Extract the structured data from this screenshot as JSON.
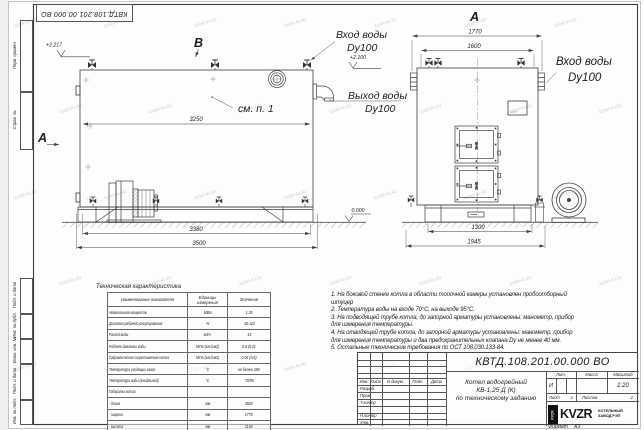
{
  "stamp_top": "КВТД.108.201.00.000 ВО",
  "watermark_text": "kotel-kv.kz",
  "margin_labels": {
    "perv": "Перв. примен.",
    "sprav": "Справ. №",
    "podp1": "Подп. и дата",
    "inv_dubl": "Инв. № дубл.",
    "vzam": "Взам. инв. №",
    "podp2": "Подп. и дата",
    "inv_podl": "Инв. № подл."
  },
  "views": {
    "side": {
      "label_b": "B",
      "label_a": "А",
      "elev": "+2.217",
      "see_note": "см. п. 1",
      "dim_body": "3250",
      "dim_3380": "3380",
      "dim_3500": "3500",
      "elev_zero": "0.000"
    },
    "front": {
      "label": "А",
      "dim_1770": "1770",
      "dim_1600": "1600",
      "dim_1300": "1300",
      "dim_1945": "1945",
      "elev": "+2.100"
    }
  },
  "callouts": {
    "inlet_left_1": "Вход воды",
    "inlet_left_2": "Dy100",
    "outlet_1": "Выход воды",
    "outlet_2": "Dy100",
    "inlet_right_1": "Вход воды",
    "inlet_right_2": "Dy100"
  },
  "spec": {
    "title": "Техническая характеристика",
    "col_name": "Наименование показателя",
    "col_unit": "Единицы измерения",
    "col_value": "Значение",
    "rows": [
      {
        "name": "Номинальная мощность",
        "unit": "МВт",
        "value": "1,25"
      },
      {
        "name": "Диапазон рабочего регулирования",
        "unit": "%",
        "value": "40-110"
      },
      {
        "name": "Расход воды",
        "unit": "м3/ч",
        "value": "43"
      },
      {
        "name": "Рабочее давление воды",
        "unit": "МПа (кгс/см2)",
        "value": "0,6 (6,0)"
      },
      {
        "name": "Гидравлическое сопротивление котла",
        "unit": "МПа (кгс/см2)",
        "value": "0,06 (0,6)"
      },
      {
        "name": "Температура уходящих газов",
        "unit": "°С",
        "value": "не более 280"
      },
      {
        "name": "Температура воды (вход/выход)",
        "unit": "°С",
        "value": "70/95"
      },
      {
        "name": "Габариты котла",
        "unit": "",
        "value": ""
      },
      {
        "name": "- длина",
        "unit": "мм",
        "value": "3500"
      },
      {
        "name": "- ширина",
        "unit": "мм",
        "value": "1770"
      },
      {
        "name": "- высота",
        "unit": "мм",
        "value": "2150"
      }
    ]
  },
  "notes": [
    "1. На боковой стенке котла в области топочной камеры установлен пробоотборный штуцер",
    "2. Температура воды на входе 70°С, на выходе 95°С.",
    "3. На подводящей трубе котла, до запорной арматуры установлены: манометр, прибор для измерения температуры.",
    "4. На отводящей трубе котла, до запорной арматуры установлены: манометр, прибор для измерения температуры и два предохранительных клапана Dу не менее 40 мм.",
    "5. Остальные технические требования по ОСТ 108.030.133-84."
  ],
  "title_block": {
    "doc_number": "КВТД.108.201.00.000  ВО",
    "name_line1": "Котел водогрейный",
    "name_line2": "КВ-1,25 Д (К)",
    "name_line3": "по техническому заданию",
    "col_izm": "Изм.",
    "col_list": "Лист",
    "col_doc": "N докум.",
    "col_podp": "Подп.",
    "col_data": "Дата",
    "row_razrab": "Разраб.",
    "row_prov": "Пров.",
    "row_tkontr": "Т.контр",
    "row_nkontr": "Н.контр",
    "row_utv": "Утв.",
    "lit_label": "Лит.",
    "lit_value": "И",
    "mass_label": "Масса",
    "scale_label": "Масштаб",
    "scale_value": "1:20",
    "sheet_label": "Лист",
    "sheet_value": "1",
    "sheets_label": "Листов",
    "sheets_value": "2",
    "logo": "KVZR",
    "logo_sub1": "КОТЕЛЬНЫЙ",
    "logo_sub2": "ЗАВОД РЭП",
    "format_label": "Формат",
    "format_value": "А3"
  }
}
